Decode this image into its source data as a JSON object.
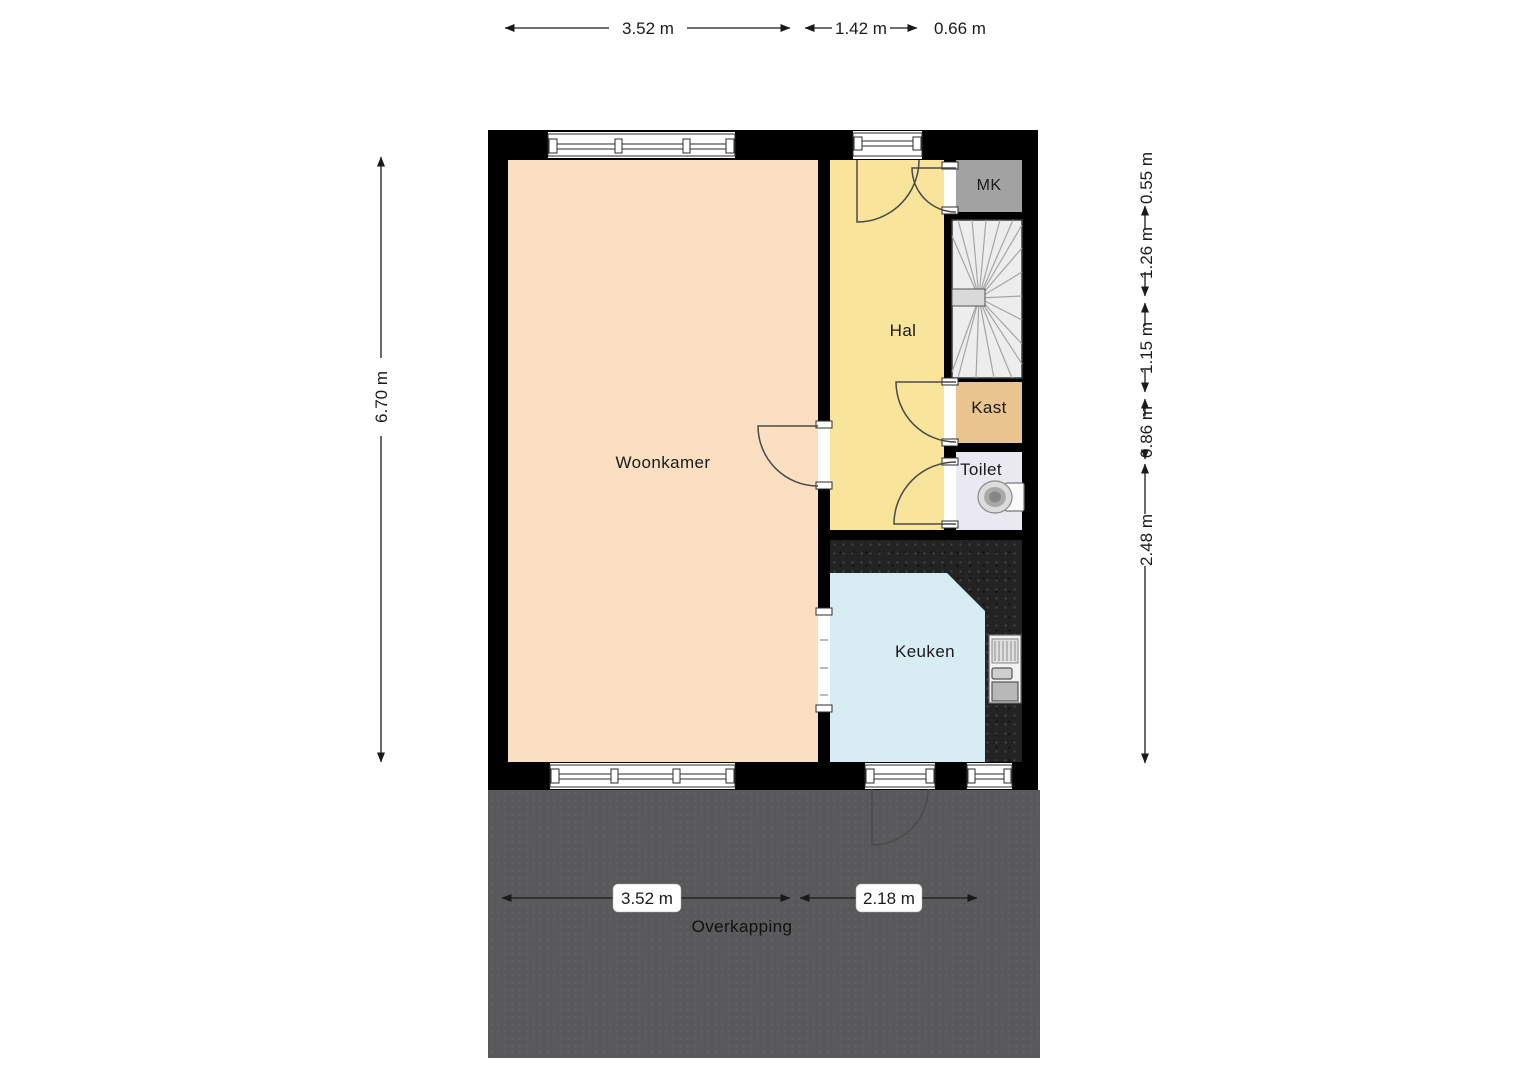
{
  "floorplan": {
    "rooms": {
      "woonkamer": {
        "label": "Woonkamer",
        "color": "#fbdfc1"
      },
      "hal": {
        "label": "Hal",
        "color": "#f9e49c"
      },
      "mk": {
        "label": "MK",
        "color": "#a2a2a2"
      },
      "kast": {
        "label": "Kast",
        "color": "#eac48f"
      },
      "toilet": {
        "label": "Toilet",
        "color": "#eae8f1"
      },
      "keuken": {
        "label": "Keuken",
        "color": "#d8edf3"
      },
      "overkapping": {
        "label": "Overkapping",
        "color": "#59595b"
      }
    },
    "dimensions": {
      "top": [
        "3.52 m",
        "1.42 m",
        "0.66 m"
      ],
      "left": [
        "6.70 m"
      ],
      "right": [
        "0.55 m",
        "1.26 m",
        "1.15 m",
        "0.86 m",
        "2.48 m"
      ],
      "bottom": [
        "3.52 m",
        "2.18 m"
      ]
    },
    "colors": {
      "wall": "#000000",
      "window": "#ffffff",
      "counter": "#232323",
      "overkapping": "#59595b",
      "stairs": "#ededed",
      "dimension_text": "#1a1a1a"
    }
  }
}
